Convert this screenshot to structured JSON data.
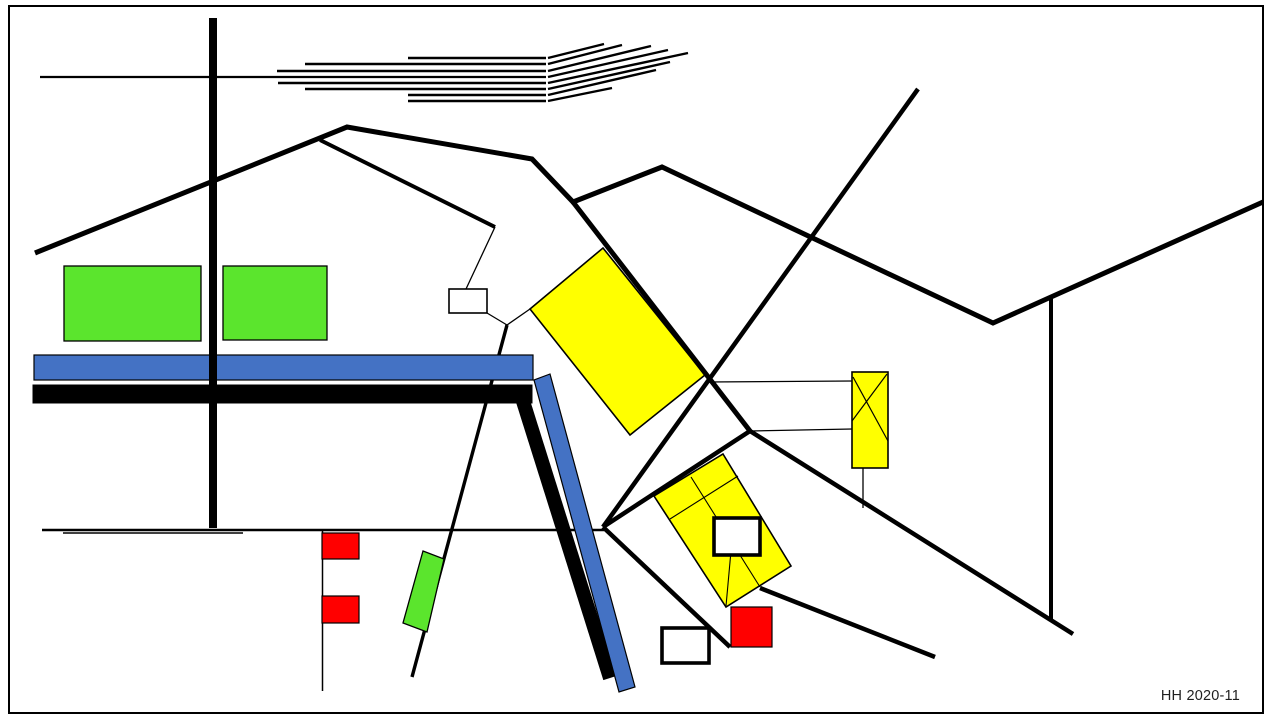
{
  "page": {
    "caption": "HH 2020-11"
  },
  "colors": {
    "yellow": "#ffff00",
    "green": "#5be52d",
    "blue": "#4472c4",
    "red": "#ff0000",
    "black": "#000000",
    "white": "#ffffff",
    "frame": "#ababab",
    "road_shadow": "#9d9d9d",
    "caption_text": "#1f1f1f",
    "background": "#ffffff"
  },
  "inventory": {
    "green_rectangles": 3,
    "red_squares": 3,
    "yellow_areas": 3,
    "white_boxes": 3,
    "blue_bars": 2,
    "black_thick_bars": 2,
    "hatch_track_lines": 8
  }
}
